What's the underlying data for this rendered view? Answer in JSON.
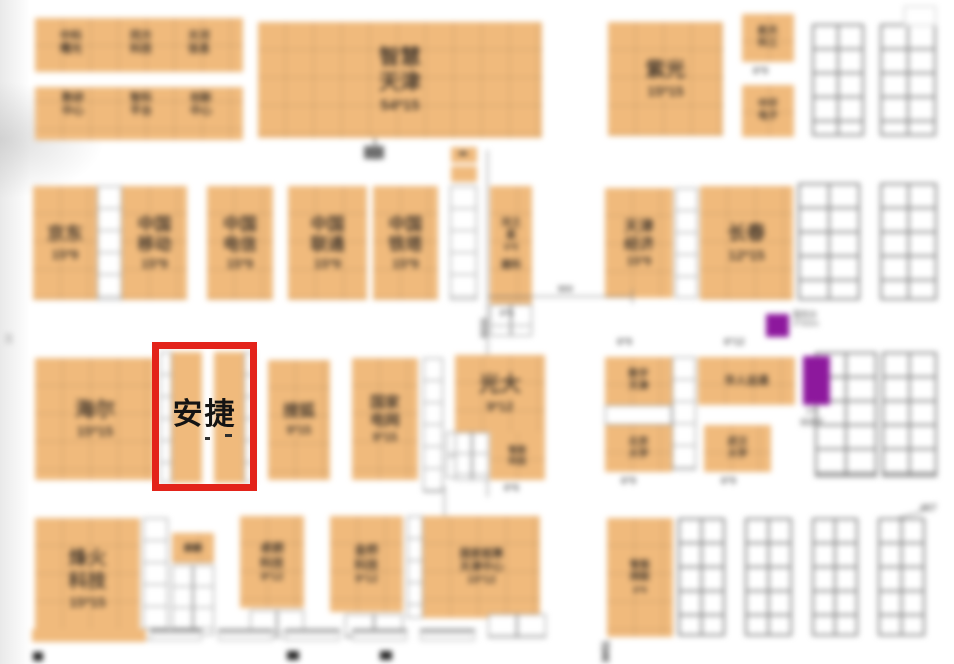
{
  "highlight": {
    "label": "安捷",
    "box_color": "#e3231a"
  },
  "colors": {
    "booth_orange": "#f0ba7c",
    "purple": "#8d189d"
  },
  "booths": {
    "sugon": {
      "name": "中科曙光"
    },
    "tongfang": {
      "name": "同方科技"
    },
    "tianhe": {
      "name": "天河信息"
    },
    "c1": {
      "name": "数研中心"
    },
    "c2": {
      "name": "智科平台"
    },
    "c3": {
      "name": "创新中心"
    },
    "smart": {
      "name": "智慧天津",
      "size": "54*15"
    },
    "ziguang": {
      "name": "紫光",
      "size": "15*15"
    },
    "hangtian": {
      "name": "航天科工"
    },
    "zhonghuan": {
      "name": "中环电子"
    },
    "jingdong": {
      "name": "京东",
      "size": "15*9"
    },
    "yidong": {
      "name": "中国移动",
      "size": "15*9"
    },
    "dianxin": {
      "name": "中国电信",
      "size": "15*9"
    },
    "liantong": {
      "name": "中国联通",
      "size": "15*9"
    },
    "tieta": {
      "name": "中国铁塔",
      "size": "15*9"
    },
    "hezhixing": {
      "name": "河之星",
      "size": "6*9"
    },
    "jianke": {
      "name": "建科",
      "size": "6*6"
    },
    "tianjin": {
      "name": "天津经济",
      "size": "15*9"
    },
    "changchun": {
      "name": "长春",
      "size": "12*15"
    },
    "haier": {
      "name": "海尔",
      "size": "15*15"
    },
    "anjie": {
      "name": "安捷"
    },
    "souhu": {
      "name": "搜狐",
      "size": "9*15"
    },
    "guowang": {
      "name": "国家电网",
      "size": "9*15"
    },
    "guangda": {
      "name": "光大",
      "size": "9*12"
    },
    "gdsub": {
      "name": "智能科技",
      "size": "6*6"
    },
    "shuzitj": {
      "name": "数字天津"
    },
    "beida": {
      "name": "北京大学",
      "size": "6*9"
    },
    "huaren": {
      "name": "华人运通"
    },
    "wuda": {
      "name": "武汉大学",
      "size": "6*9"
    },
    "fenghuo": {
      "name": "烽火科技",
      "size": "15*15"
    },
    "qilin": {
      "name": "麒麟"
    },
    "zhuolang": {
      "name": "卓朗科技",
      "size": "9*12"
    },
    "jinqiao": {
      "name": "金桥科技",
      "size": "9*12"
    },
    "chaosuan": {
      "name": "国家超算天津中心",
      "size": "15*12"
    },
    "wangluo": {
      "name": "智能网联",
      "size": "6*9"
    }
  },
  "labels": {
    "l69_top": "6*9",
    "l69_a": "6*9",
    "l612": "6*12",
    "l69_bj": "6*9",
    "l69_wh": "6*9",
    "l66_hzx": "6*6",
    "cap1a": "服务台",
    "cap1b": "3*3/2m",
    "cap2a": "3*9",
    "cap2b": "体验区"
  },
  "dims": {
    "d800": "800",
    "d8000": "8000",
    "d3651": "3651",
    "d467": "467",
    "d10": "10"
  }
}
